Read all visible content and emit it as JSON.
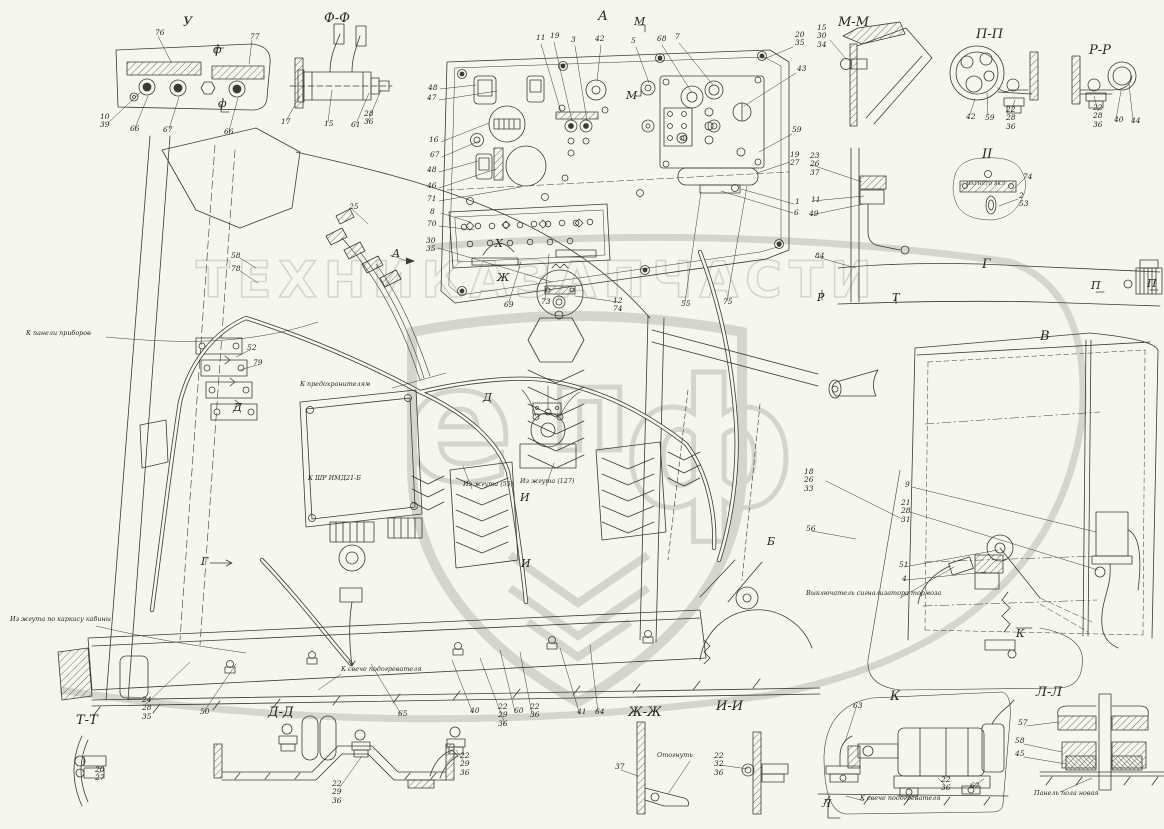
{
  "watermark": {
    "word1": "ТЕХНИКА",
    "word2": "ЗАПЧАСТИ",
    "letters": [
      "е",
      "п",
      "ф"
    ],
    "color": "#b3b8ac"
  },
  "ink_color": "#3b3b35",
  "background": "#f6f6f0",
  "labels": [
    {
      "t": "У",
      "x": 183,
      "y": 16,
      "c": "title",
      "n": "view-title-u"
    },
    {
      "t": "Ф-Ф",
      "x": 324,
      "y": 12,
      "c": "title",
      "n": "section-title-f-f"
    },
    {
      "t": "А",
      "x": 598,
      "y": 10,
      "c": "title",
      "n": "view-title-a"
    },
    {
      "t": "М-М",
      "x": 838,
      "y": 16,
      "c": "title",
      "n": "section-title-m-m"
    },
    {
      "t": "П-П",
      "x": 976,
      "y": 28,
      "c": "title",
      "n": "section-title-p-p"
    },
    {
      "t": "Р-Р",
      "x": 1089,
      "y": 44,
      "c": "title",
      "n": "section-title-r-r"
    },
    {
      "t": "II",
      "x": 982,
      "y": 148,
      "c": "title",
      "n": "detail-title-ii"
    },
    {
      "t": "Г",
      "x": 982,
      "y": 258,
      "c": "title",
      "n": "view-title-g"
    },
    {
      "t": "В",
      "x": 1040,
      "y": 330,
      "c": "title",
      "n": "view-title-v"
    },
    {
      "t": "Т-Т",
      "x": 76,
      "y": 714,
      "c": "title",
      "n": "section-title-t-t"
    },
    {
      "t": "Д-Д",
      "x": 268,
      "y": 706,
      "c": "title",
      "n": "section-title-d-d"
    },
    {
      "t": "Ж-Ж",
      "x": 628,
      "y": 706,
      "c": "title",
      "n": "section-title-zh-zh"
    },
    {
      "t": "И-И",
      "x": 716,
      "y": 700,
      "c": "title",
      "n": "section-title-i-i"
    },
    {
      "t": "К",
      "x": 890,
      "y": 690,
      "c": "title",
      "n": "view-title-k"
    },
    {
      "t": "Л-Л",
      "x": 1036,
      "y": 686,
      "c": "title",
      "n": "section-title-l-l"
    },
    {
      "t": "М",
      "x": 634,
      "y": 16,
      "c": "marker",
      "n": "cut-marker-m-top"
    },
    {
      "t": "М",
      "x": 626,
      "y": 90,
      "c": "marker",
      "n": "cut-marker-m-bottom"
    },
    {
      "t": "ф",
      "x": 213,
      "y": 44,
      "c": "marker",
      "n": "cut-marker-f-top"
    },
    {
      "t": "ф",
      "x": 218,
      "y": 98,
      "c": "marker",
      "n": "cut-marker-f-bottom"
    },
    {
      "t": "А",
      "x": 392,
      "y": 248,
      "c": "marker",
      "n": "view-arrow-a"
    },
    {
      "t": "Х",
      "x": 495,
      "y": 238,
      "c": "marker",
      "n": "cut-marker-x"
    },
    {
      "t": "Ж",
      "x": 497,
      "y": 272,
      "c": "marker",
      "n": "cut-marker-zh"
    },
    {
      "t": "Д",
      "x": 233,
      "y": 402,
      "c": "marker",
      "n": "cut-marker-d-1"
    },
    {
      "t": "Д",
      "x": 483,
      "y": 392,
      "c": "marker",
      "n": "cut-marker-d-2"
    },
    {
      "t": "И",
      "x": 520,
      "y": 492,
      "c": "marker",
      "n": "cut-marker-i-1"
    },
    {
      "t": "И",
      "x": 521,
      "y": 558,
      "c": "marker",
      "n": "cut-marker-i-2"
    },
    {
      "t": "Г",
      "x": 201,
      "y": 556,
      "c": "marker",
      "n": "view-arrow-g"
    },
    {
      "t": "Б",
      "x": 767,
      "y": 536,
      "c": "marker",
      "n": "view-marker-b"
    },
    {
      "t": "К",
      "x": 1016,
      "y": 628,
      "c": "marker",
      "n": "view-arrow-k"
    },
    {
      "t": "Л",
      "x": 822,
      "y": 798,
      "c": "marker",
      "n": "cut-marker-l"
    },
    {
      "t": "Р",
      "x": 817,
      "y": 292,
      "c": "marker",
      "n": "cut-marker-r"
    },
    {
      "t": "Т",
      "x": 892,
      "y": 292,
      "c": "marker",
      "n": "cut-marker-t"
    },
    {
      "t": "П",
      "x": 1091,
      "y": 280,
      "c": "marker",
      "n": "cut-marker-p-1"
    },
    {
      "t": "П",
      "x": 1147,
      "y": 278,
      "c": "marker",
      "n": "cut-marker-p-2"
    },
    {
      "t": "76",
      "x": 155,
      "y": 29,
      "c": "callout"
    },
    {
      "t": "77",
      "x": 250,
      "y": 33,
      "c": "callout"
    },
    {
      "t": "10\n39",
      "x": 100,
      "y": 113,
      "c": "callout"
    },
    {
      "t": "66",
      "x": 130,
      "y": 125,
      "c": "callout"
    },
    {
      "t": "67",
      "x": 163,
      "y": 126,
      "c": "callout"
    },
    {
      "t": "66",
      "x": 224,
      "y": 128,
      "c": "callout"
    },
    {
      "t": "17",
      "x": 281,
      "y": 118,
      "c": "callout"
    },
    {
      "t": "15",
      "x": 324,
      "y": 120,
      "c": "callout"
    },
    {
      "t": "61",
      "x": 351,
      "y": 121,
      "c": "callout"
    },
    {
      "t": "28\n36",
      "x": 364,
      "y": 110,
      "c": "callout"
    },
    {
      "t": "48",
      "x": 428,
      "y": 84,
      "c": "callout"
    },
    {
      "t": "47",
      "x": 427,
      "y": 94,
      "c": "callout"
    },
    {
      "t": "16",
      "x": 429,
      "y": 136,
      "c": "callout"
    },
    {
      "t": "67",
      "x": 430,
      "y": 151,
      "c": "callout"
    },
    {
      "t": "48",
      "x": 427,
      "y": 166,
      "c": "callout"
    },
    {
      "t": "46",
      "x": 427,
      "y": 182,
      "c": "callout"
    },
    {
      "t": "71",
      "x": 427,
      "y": 195,
      "c": "callout"
    },
    {
      "t": "8",
      "x": 430,
      "y": 208,
      "c": "callout"
    },
    {
      "t": "70",
      "x": 427,
      "y": 220,
      "c": "callout"
    },
    {
      "t": "30\n35",
      "x": 426,
      "y": 237,
      "c": "callout"
    },
    {
      "t": "11",
      "x": 536,
      "y": 34,
      "c": "callout"
    },
    {
      "t": "19",
      "x": 550,
      "y": 32,
      "c": "callout"
    },
    {
      "t": "3",
      "x": 571,
      "y": 36,
      "c": "callout"
    },
    {
      "t": "42",
      "x": 595,
      "y": 35,
      "c": "callout"
    },
    {
      "t": "5",
      "x": 631,
      "y": 37,
      "c": "callout"
    },
    {
      "t": "68",
      "x": 657,
      "y": 35,
      "c": "callout"
    },
    {
      "t": "7",
      "x": 675,
      "y": 33,
      "c": "callout"
    },
    {
      "t": "20\n35",
      "x": 795,
      "y": 31,
      "c": "callout"
    },
    {
      "t": "43",
      "x": 797,
      "y": 65,
      "c": "callout"
    },
    {
      "t": "59",
      "x": 792,
      "y": 126,
      "c": "callout"
    },
    {
      "t": "19\n27",
      "x": 790,
      "y": 151,
      "c": "callout"
    },
    {
      "t": "1",
      "x": 795,
      "y": 198,
      "c": "callout"
    },
    {
      "t": "6",
      "x": 794,
      "y": 209,
      "c": "callout"
    },
    {
      "t": "69",
      "x": 504,
      "y": 301,
      "c": "callout"
    },
    {
      "t": "73",
      "x": 541,
      "y": 298,
      "c": "callout"
    },
    {
      "t": "12\n74",
      "x": 613,
      "y": 297,
      "c": "callout"
    },
    {
      "t": "55",
      "x": 681,
      "y": 300,
      "c": "callout"
    },
    {
      "t": "75",
      "x": 723,
      "y": 298,
      "c": "callout"
    },
    {
      "t": "23\n26\n37",
      "x": 810,
      "y": 152,
      "c": "callout"
    },
    {
      "t": "11",
      "x": 811,
      "y": 196,
      "c": "callout"
    },
    {
      "t": "49",
      "x": 809,
      "y": 210,
      "c": "callout"
    },
    {
      "t": "84",
      "x": 815,
      "y": 252,
      "c": "callout"
    },
    {
      "t": "15\n30\n34",
      "x": 817,
      "y": 24,
      "c": "callout"
    },
    {
      "t": "42",
      "x": 966,
      "y": 113,
      "c": "callout"
    },
    {
      "t": "59",
      "x": 985,
      "y": 114,
      "c": "callout"
    },
    {
      "t": "22\n28\n36",
      "x": 1006,
      "y": 106,
      "c": "callout"
    },
    {
      "t": "22\n28\n36",
      "x": 1093,
      "y": 104,
      "c": "callout"
    },
    {
      "t": "40",
      "x": 1114,
      "y": 116,
      "c": "callout"
    },
    {
      "t": "44",
      "x": 1131,
      "y": 117,
      "c": "callout"
    },
    {
      "t": "74",
      "x": 1023,
      "y": 173,
      "c": "callout"
    },
    {
      "t": "2\n53",
      "x": 1019,
      "y": 192,
      "c": "callout"
    },
    {
      "t": "9",
      "x": 905,
      "y": 481,
      "c": "callout"
    },
    {
      "t": "21\n28\n31",
      "x": 901,
      "y": 499,
      "c": "callout"
    },
    {
      "t": "18\n26\n33",
      "x": 804,
      "y": 468,
      "c": "callout"
    },
    {
      "t": "56",
      "x": 806,
      "y": 525,
      "c": "callout"
    },
    {
      "t": "51",
      "x": 899,
      "y": 561,
      "c": "callout"
    },
    {
      "t": "4",
      "x": 902,
      "y": 575,
      "c": "callout"
    },
    {
      "t": "52",
      "x": 247,
      "y": 344,
      "c": "callout"
    },
    {
      "t": "79",
      "x": 253,
      "y": 359,
      "c": "callout"
    },
    {
      "t": "25",
      "x": 349,
      "y": 203,
      "c": "callout"
    },
    {
      "t": "58",
      "x": 231,
      "y": 252,
      "c": "callout"
    },
    {
      "t": "78",
      "x": 231,
      "y": 265,
      "c": "callout"
    },
    {
      "t": "24\n28\n35",
      "x": 142,
      "y": 696,
      "c": "callout"
    },
    {
      "t": "50",
      "x": 200,
      "y": 708,
      "c": "callout"
    },
    {
      "t": "65",
      "x": 398,
      "y": 710,
      "c": "callout"
    },
    {
      "t": "40",
      "x": 470,
      "y": 707,
      "c": "callout"
    },
    {
      "t": "22\n29\n36",
      "x": 498,
      "y": 703,
      "c": "callout"
    },
    {
      "t": "60",
      "x": 514,
      "y": 707,
      "c": "callout"
    },
    {
      "t": "22\n36",
      "x": 530,
      "y": 703,
      "c": "callout"
    },
    {
      "t": "41",
      "x": 577,
      "y": 708,
      "c": "callout"
    },
    {
      "t": "64",
      "x": 595,
      "y": 708,
      "c": "callout"
    },
    {
      "t": "22\n29\n36",
      "x": 460,
      "y": 752,
      "c": "callout"
    },
    {
      "t": "37",
      "x": 615,
      "y": 763,
      "c": "callout"
    },
    {
      "t": "22\n32\n36",
      "x": 714,
      "y": 752,
      "c": "callout"
    },
    {
      "t": "20\n27",
      "x": 95,
      "y": 766,
      "c": "callout"
    },
    {
      "t": "22\n29\n36",
      "x": 332,
      "y": 780,
      "c": "callout"
    },
    {
      "t": "63",
      "x": 853,
      "y": 702,
      "c": "callout"
    },
    {
      "t": "22\n36",
      "x": 941,
      "y": 776,
      "c": "callout"
    },
    {
      "t": "62",
      "x": 970,
      "y": 782,
      "c": "callout"
    },
    {
      "t": "57",
      "x": 1018,
      "y": 719,
      "c": "callout"
    },
    {
      "t": "58",
      "x": 1015,
      "y": 737,
      "c": "callout"
    },
    {
      "t": "45",
      "x": 1015,
      "y": 750,
      "c": "callout"
    },
    {
      "t": "К панели приборов",
      "x": 26,
      "y": 330,
      "c": "note",
      "n": "note-to-instrument-panel"
    },
    {
      "t": "К предохранителям",
      "x": 300,
      "y": 381,
      "c": "note",
      "n": "note-to-fuses"
    },
    {
      "t": "К ШР ИМД21-Б",
      "x": 308,
      "y": 475,
      "c": "note",
      "n": "note-to-shr-imd21b"
    },
    {
      "t": "Из жгута (55)",
      "x": 463,
      "y": 481,
      "c": "note",
      "n": "note-from-harness-55"
    },
    {
      "t": "Из жгута (127)",
      "x": 520,
      "y": 478,
      "c": "note",
      "n": "note-from-harness-127"
    },
    {
      "t": "Из жгута по каркасу кабины",
      "x": 10,
      "y": 616,
      "c": "note",
      "n": "note-harness-cab-frame"
    },
    {
      "t": "Выключатель сигнализатора тормоза",
      "x": 806,
      "y": 590,
      "c": "note",
      "n": "note-brake-signal-switch"
    },
    {
      "t": "К свече подогревателя",
      "x": 341,
      "y": 666,
      "c": "note",
      "n": "note-to-heater-plug-1"
    },
    {
      "t": "Отогнуть",
      "x": 657,
      "y": 752,
      "c": "note",
      "n": "note-bend-away"
    },
    {
      "t": "К свече подогревателя",
      "x": 860,
      "y": 795,
      "c": "note",
      "n": "note-to-heater-plug-2"
    },
    {
      "t": "Панель пола новая",
      "x": 1034,
      "y": 790,
      "c": "note",
      "n": "note-floor-panel-new"
    },
    {
      "t": "МАГНЕТО ВКЛ",
      "x": 966,
      "y": 183,
      "c": "plate",
      "n": "plate-magneto"
    }
  ]
}
